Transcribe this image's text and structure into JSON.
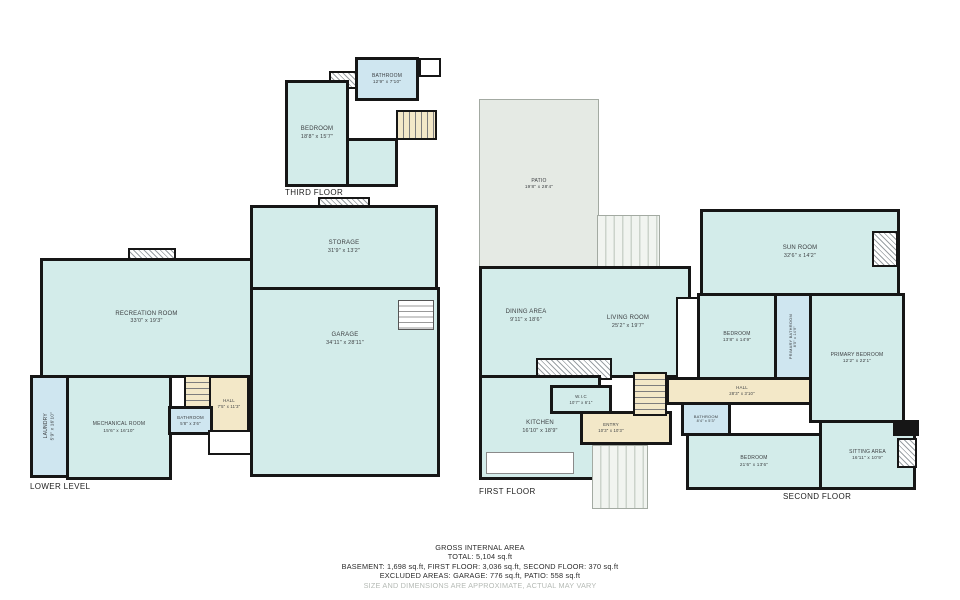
{
  "colors": {
    "room_fill": "#d3ecea",
    "bathroom_fill": "#cfe6f0",
    "hall_fill": "#f3e8c8",
    "patio_fill": "#e5eae4",
    "wall": "#161616",
    "label_text": "#3d4043",
    "disclaimer_text": "#b5bab5"
  },
  "floors": [
    {
      "id": "third-floor",
      "label": "THIRD FLOOR",
      "rooms": {
        "bedroom": {
          "name": "BEDROOM",
          "dims": "18'8\" x 15'7\""
        },
        "bathroom": {
          "name": "BATHROOM",
          "dims": "12'9\" x 7'10\""
        }
      }
    },
    {
      "id": "lower-level",
      "label": "LOWER LEVEL",
      "rooms": {
        "recreation_room": {
          "name": "RECREATION ROOM",
          "dims": "33'0\" x 19'3\""
        },
        "mechanical_room": {
          "name": "MECHANICAL ROOM",
          "dims": "15'6\" x 16'10\""
        },
        "laundry": {
          "name": "LAUNDRY",
          "dims": "5'9\" x 16'10\""
        },
        "bathroom": {
          "name": "BATHROOM",
          "dims": "5'8\" x 3'6\""
        },
        "hall": {
          "name": "HALL",
          "dims": "7'5\" x 11'3\""
        },
        "storage": {
          "name": "STORAGE",
          "dims": "31'9\" x 13'2\""
        },
        "garage": {
          "name": "GARAGE",
          "dims": "34'11\" x 28'11\""
        }
      }
    },
    {
      "id": "first-floor",
      "label": "FIRST FLOOR",
      "rooms": {
        "patio": {
          "name": "PATIO",
          "dims": "19'8\" x 28'4\""
        },
        "dining_area": {
          "name": "DINING AREA",
          "dims": "9'11\" x 18'6\""
        },
        "living_room": {
          "name": "LIVING ROOM",
          "dims": "25'2\" x 19'7\""
        },
        "wic": {
          "name": "W.I.C",
          "dims": "10'7\" x 6'1\""
        },
        "kitchen": {
          "name": "KITCHEN",
          "dims": "16'10\" x 18'9\""
        },
        "entry": {
          "name": "ENTRY",
          "dims": "10'3\" x 10'3\""
        }
      }
    },
    {
      "id": "second-floor",
      "label": "SECOND FLOOR",
      "rooms": {
        "sun_room": {
          "name": "SUN ROOM",
          "dims": "32'6\" x 14'2\""
        },
        "bedroom_front": {
          "name": "BEDROOM",
          "dims": "13'8\" x 14'9\""
        },
        "primary_bathroom": {
          "name": "PRIMARY BATHROOM",
          "dims": "8'5\" x 14'9\""
        },
        "primary_bedroom": {
          "name": "PRIMARY BEDROOM",
          "dims": "12'2\" x 22'1\""
        },
        "hall": {
          "name": "HALL",
          "dims": "28'3\" x 3'10\""
        },
        "bathroom": {
          "name": "BATHROOM",
          "dims": "8'4\" x 5'3\""
        },
        "bedroom_back": {
          "name": "BEDROOM",
          "dims": "21'6\" x 13'6\""
        },
        "sitting_area": {
          "name": "SITTING AREA",
          "dims": "16'11\" x 10'9\""
        }
      }
    }
  ],
  "footer": {
    "heading": "GROSS INTERNAL AREA",
    "total": "TOTAL: 5,104 sq.ft",
    "floors_line": "BASEMENT: 1,698 sq.ft, FIRST FLOOR: 3,036 sq.ft, SECOND FLOOR: 370 sq.ft",
    "excluded_line": "EXCLUDED AREAS: GARAGE: 776 sq.ft, PATIO: 558 sq.ft",
    "disclaimer": "SIZE AND DIMENSIONS ARE APPROXIMATE, ACTUAL MAY VARY"
  }
}
